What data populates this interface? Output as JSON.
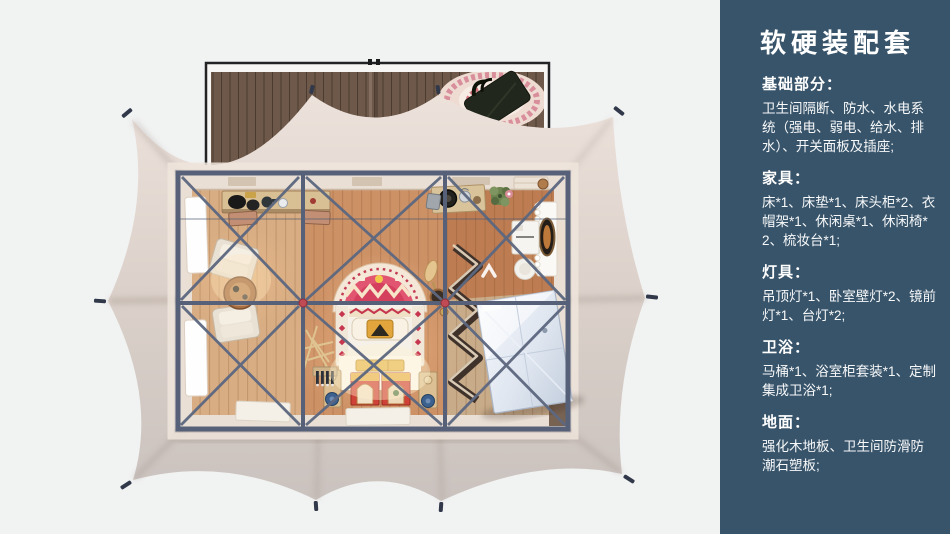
{
  "sidebar": {
    "title": "软硬装配套",
    "sections": [
      {
        "heading": "基础部分：",
        "body": "卫生间隔断、防水、水电系统（强电、弱电、给水、排水）、开关面板及插座;"
      },
      {
        "heading": "家具：",
        "body": "床*1、床垫*1、床头柜*2、衣帽架*1、休闲桌*1、休闲椅*2、梳妆台*1;"
      },
      {
        "heading": "灯具：",
        "body": "吊顶灯*1、卧室壁灯*2、镜前灯*1、台灯*2;"
      },
      {
        "heading": "卫浴：",
        "body": "马桶*1、浴室柜套装*1、定制集成卫浴*1;"
      },
      {
        "heading": "地面：",
        "body": "强化木地板、卫生间防滑防潮石塑板;"
      }
    ]
  },
  "figure": {
    "type": "top-view-3d-rendering",
    "parts": [
      "tent-canopy",
      "guy-line-stakes",
      "wood-deck",
      "round-rug",
      "tote-bag",
      "steel-truss-frame",
      "wood-floor",
      "bed-with-arched-headboard",
      "foot-chests",
      "nightstands",
      "lounge-chairs",
      "tea-table",
      "console-desk",
      "desk-chairs",
      "side-windows",
      "zigzag-clothes-rack",
      "integrated-bathroom-pod",
      "dressing-table",
      "oval-mirror",
      "stool",
      "stove-table",
      "potted-plant",
      "door-mats"
    ]
  },
  "colors": {
    "page_background": "#f1f2f2",
    "sidebar_background": "#38546a",
    "sidebar_text": "#ffffff",
    "tent_fabric_light": "#ece2db",
    "tent_fabric_dark": "#cac2be",
    "steel_frame": "#566179",
    "wood_floor": "#cd9166",
    "deck_wood": "#6d5849",
    "headboard_red": "#d94f6a",
    "stake_dark": "#30384a"
  }
}
